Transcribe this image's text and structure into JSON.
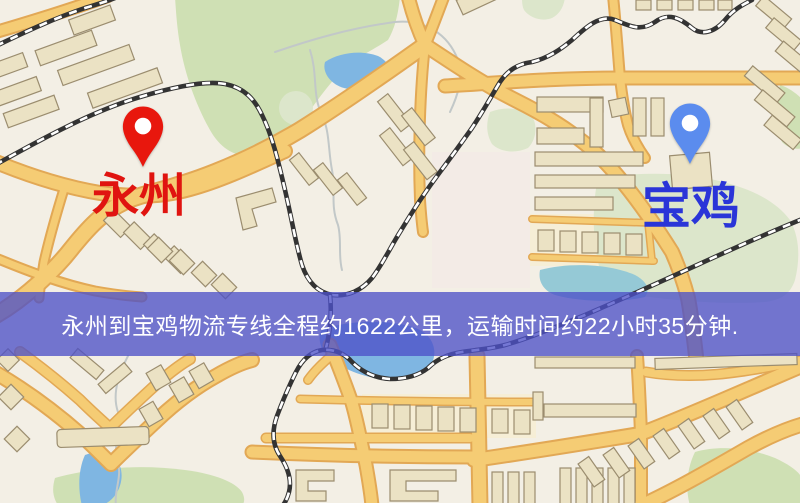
{
  "map": {
    "origin": {
      "name": "永州",
      "pin_color": "#e8170d",
      "label_color": "#e01410"
    },
    "destination": {
      "name": "宝鸡",
      "pin_color": "#5b8cee",
      "label_color": "#2a35d8"
    },
    "banner": {
      "text": "永州到宝鸡物流专线全程约1622公里，运输时间约22小时35分钟.",
      "origin": "永州",
      "destination": "宝鸡",
      "distance_text": "约1622公里",
      "duration_text": "约22小时35分钟"
    }
  },
  "colors": {
    "map_bg": "#f3efe5",
    "road_fill": "#f5cc74",
    "road_casing": "#e2a855",
    "park_green": "#cfe0b4",
    "park_pale": "#dce6cb",
    "water_blue": "#7fb6e2",
    "water_teal": "#95c9d6",
    "building_fill": "#ebe2c4",
    "building_stroke": "#9b8d6f",
    "rail_dark": "#333333",
    "stream": "#c2c8c8",
    "block_yellow": "#f6eed6",
    "block_pink": "#f2e8e8",
    "banner_bg": "#4d51c8",
    "banner_text": "#ffffff",
    "origin_label": "#e01410",
    "destination_label": "#2a35d8"
  }
}
